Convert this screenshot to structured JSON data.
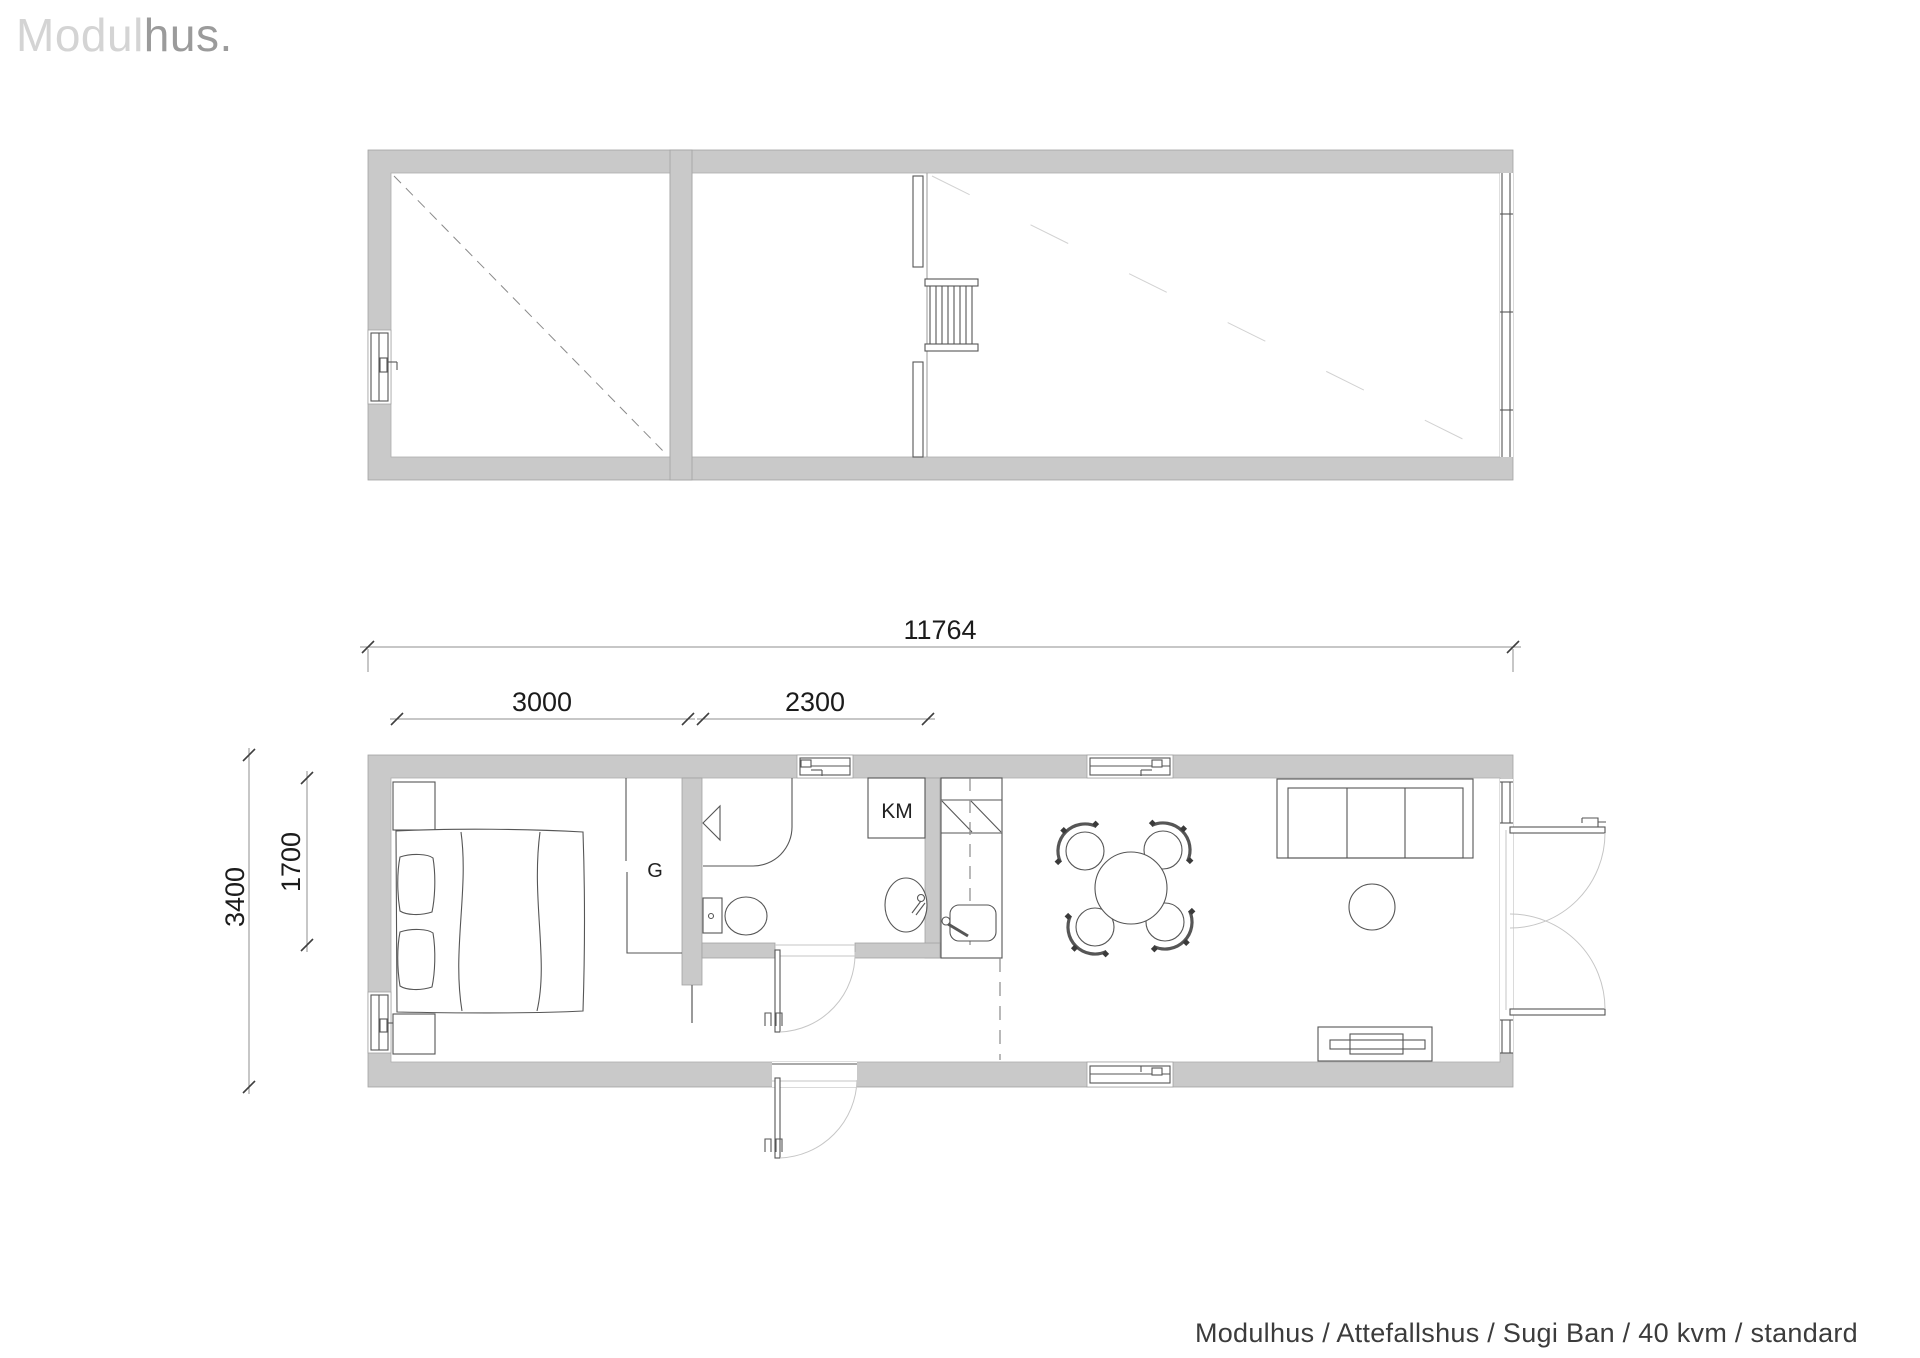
{
  "logo": {
    "light": "Modul",
    "dark": "hus."
  },
  "caption": "Modulhus / Attefallshus / Sugi Ban / 40 kvm / standard",
  "dimensions": {
    "total_width": "11764",
    "bedroom_width": "3000",
    "bathroom_width": "2300",
    "bedroom_depth": "1700",
    "total_depth": "3400"
  },
  "labels": {
    "wardrobe": "G",
    "washing_machine": "KM"
  },
  "colors": {
    "wall": "#c9c9c9",
    "wall_edge": "#a2a2a2",
    "drawing_line": "#565656",
    "swing_arc": "#c6c6c6",
    "logo_light": "#d4d4d4",
    "logo_dark": "#9b9b9b",
    "dimension_text": "#1b1b1b"
  }
}
